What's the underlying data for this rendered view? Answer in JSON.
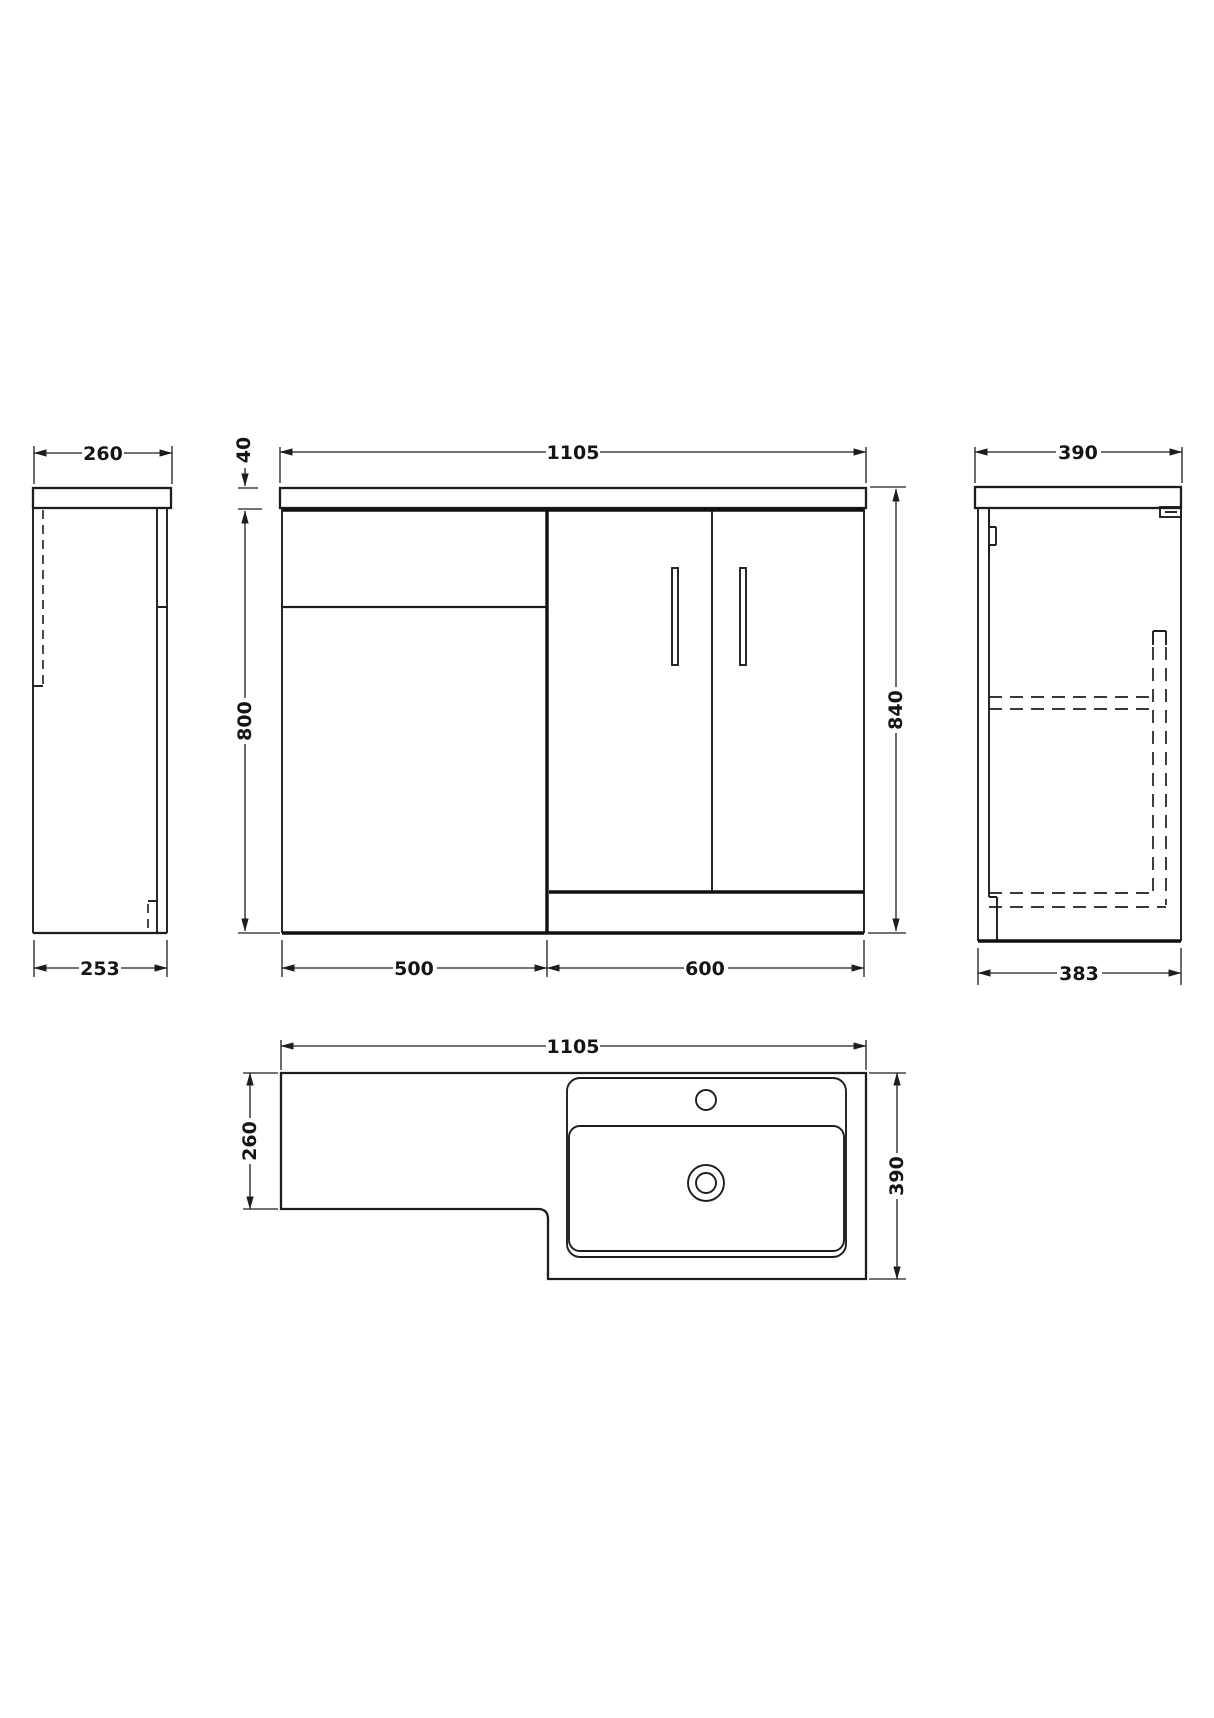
{
  "drawing": {
    "background": "#ffffff",
    "line_color": "#1d1d1d",
    "views": {
      "left_side": {
        "label": "wc-unit-side-view",
        "width_top": "260",
        "width_bottom": "253"
      },
      "front": {
        "label": "front-elevation",
        "overall_width": "1105",
        "worktop_thickness": "40",
        "cabinet_height": "800",
        "overall_height": "840",
        "wc_unit_width": "500",
        "vanity_unit_width": "600"
      },
      "right_side": {
        "label": "vanity-side-view",
        "depth_top": "390",
        "depth_bottom": "383"
      },
      "plan": {
        "label": "plan-view",
        "overall_width": "1105",
        "wc_depth": "260",
        "overall_depth": "390"
      }
    }
  }
}
